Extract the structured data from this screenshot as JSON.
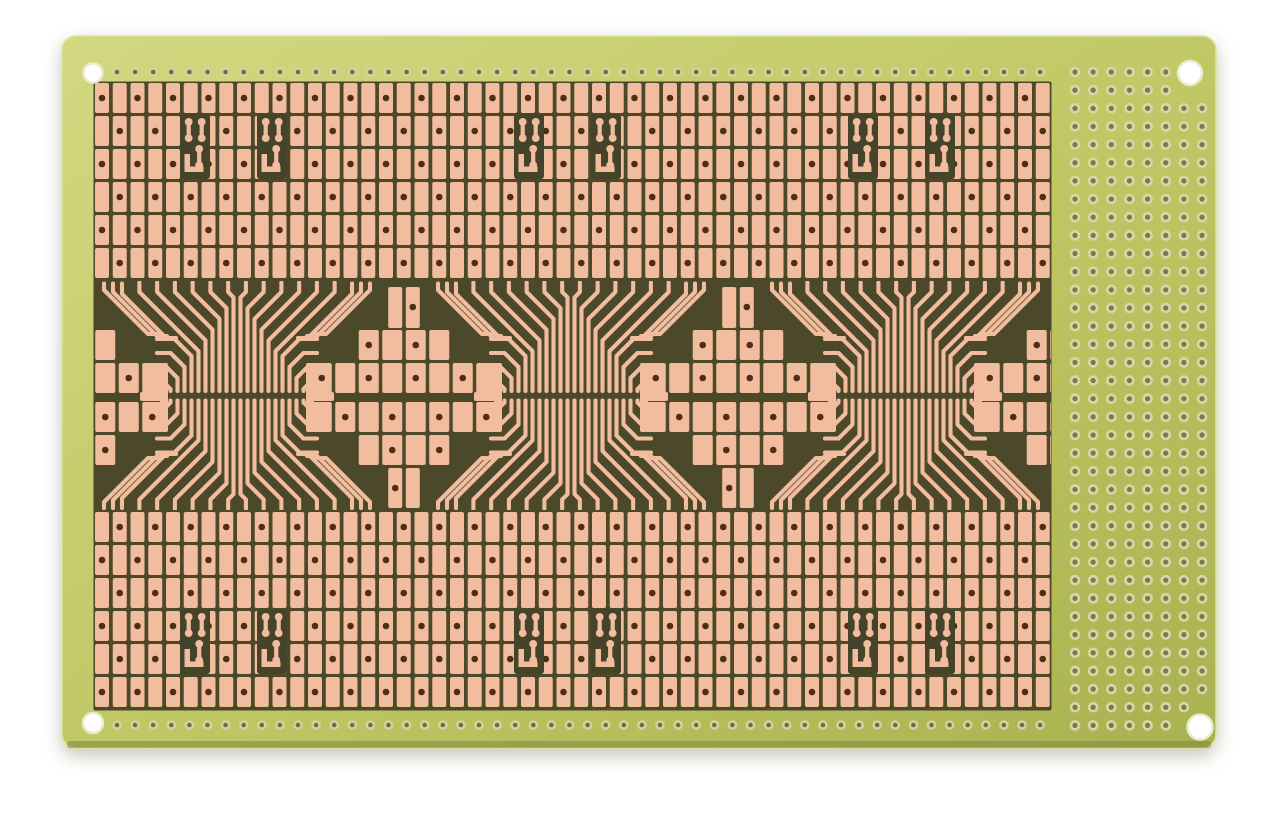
{
  "scene": {
    "object_name": "smd-prototyping-perfboard-pcb",
    "background_color": "#ffffff"
  },
  "colors": {
    "board_gradient": [
      "#d2d880",
      "#c1c866",
      "#a9b250"
    ],
    "board_stroke": "#e0e49c",
    "board_edge_dark": "#7d863e",
    "substrate": "#4b4929",
    "window_dark": "#45442a",
    "copper": "#f2bd9e",
    "pad_hole": "#4e2d1b",
    "ring_outer": "#d9d0a0",
    "ring_hole": "#6f6e41",
    "perf_ring": "#dcd4a8",
    "perf_hole": "#7b7946",
    "mount_hole_fill": "#ffffff",
    "mount_hole_stroke": "#ecead0",
    "shadow": "rgba(90,90,55,0.35)"
  },
  "board": {
    "x": 62,
    "y": 36,
    "width": 1154,
    "height": 712,
    "corner_radius": 14
  },
  "mounting_holes": [
    {
      "x": 93,
      "y": 73,
      "r": 9.5
    },
    {
      "x": 1190,
      "y": 73,
      "r": 12
    },
    {
      "x": 93,
      "y": 723,
      "r": 10
    },
    {
      "x": 1200,
      "y": 727,
      "r": 12.5
    }
  ],
  "edge_rows": {
    "top": {
      "y": 72,
      "x_start": 117,
      "count": 52,
      "pitch": 18.1
    },
    "bottom": {
      "y": 725,
      "x_start": 117,
      "count": 52,
      "pitch": 18.1
    },
    "ring_r": 4.8,
    "hole_r": 2.3
  },
  "matrix": {
    "x_start": 95,
    "cols": 54,
    "col_pitch": 17.75,
    "pad_w": 14,
    "pad_h": 30,
    "row_pitch": 33,
    "hole_r": 3.3,
    "substrate": {
      "x": 93.5,
      "y": 81.5,
      "w": 958,
      "h": 629
    },
    "bands": [
      {
        "y_start": 83,
        "rows": 6,
        "row_offset": 0
      },
      {
        "y_start": 512,
        "rows": 6,
        "row_offset": 13
      }
    ]
  },
  "middle_band": {
    "clip": {
      "x": 95,
      "y": 281,
      "w": 956,
      "h": 229
    },
    "mirror_sum": 791.5,
    "fanouts": {
      "centers": [
        237,
        571,
        905
      ],
      "finger_count": 20,
      "finger_pitch": 7,
      "finger_span_half": 66.5,
      "trace_width": 4.1,
      "funnel_half_span": 97.6,
      "funnel_pitch": 17.75,
      "stub_y": 282.5,
      "bend_y": 292,
      "finger_end_y": 391,
      "outer_count": 4,
      "outer_turn_y": 389,
      "outer_turn_step": 11,
      "outer_diag": 8,
      "outer_diag_step": 3,
      "outer_end_dx": 80,
      "bars": [
        {
          "dx": -97,
          "w": 28
        },
        {
          "dx": 69,
          "w": 28
        }
      ],
      "bar_y": 392,
      "bar_h": 9
    },
    "clusters": {
      "centers": [
        70,
        404,
        738,
        1072
      ],
      "pad_w": 20,
      "pad_h": 30,
      "pitch": 23.5,
      "rows": [
        {
          "y": 330,
          "offsets": [
            -1.5,
            -0.5,
            0.5,
            1.5
          ],
          "holes": [
            0,
            2
          ]
        },
        {
          "y": 363,
          "offsets": [
            -3.5,
            -2.5,
            -1.5,
            -0.5,
            0.5,
            1.5,
            2.5,
            3.5
          ],
          "holes": [
            0,
            2,
            4,
            6
          ]
        },
        {
          "y": 402,
          "offsets": [
            -3.5,
            -2.5,
            -1.5,
            -0.5,
            0.5,
            1.5,
            2.5,
            3.5
          ],
          "holes": [
            1,
            3,
            5,
            7
          ]
        },
        {
          "y": 435,
          "offsets": [
            -1.5,
            -0.5,
            0.5,
            1.5
          ],
          "holes": [
            1,
            3
          ]
        }
      ],
      "strip": {
        "dx": 90,
        "w": 8,
        "y": 363,
        "h": 69
      },
      "top_pair": {
        "y": 287,
        "h": 41,
        "hole_in": "right",
        "hole_y": 307
      },
      "bottom_pair": {
        "y": 468,
        "h": 40,
        "hole_in": "left",
        "hole_y": 488
      },
      "pair_half_gap": 1.8,
      "pair_pad_w": 14,
      "wrap_count": 3,
      "wrap_base": 34,
      "wrap_step": 9,
      "wrap_diag": 44,
      "wrap_tail": 10
    }
  },
  "sot_footprints": {
    "pair_centers": [
      237,
      571,
      905
    ],
    "band_tops": [
      114,
      609
    ],
    "window": {
      "w": 30,
      "h": 65,
      "left_dx": -57,
      "right_dx": 20,
      "corner_r": 3
    },
    "bone": {
      "w": 7.4,
      "h": 24,
      "end_r": 3.9
    },
    "layout": {
      "top_bone1_dx": 5,
      "top_bone2_dx": 18,
      "bones_top_dy": 4,
      "bot_bone_dx": 15.5,
      "bot_bone_dy": 31,
      "l_trace": {
        "dx": 4.5,
        "dy": 40,
        "stem_w": 5.5,
        "stem_h": 14,
        "foot_w": 19,
        "foot_h": 5.5
      }
    }
  },
  "perfboard": {
    "x_start": 1075,
    "y_start": 72,
    "cols": 8,
    "rows": 37,
    "pitch": 18.15,
    "ring_r": 5.3,
    "hole_r": 2.6,
    "keepout_r": 22
  }
}
